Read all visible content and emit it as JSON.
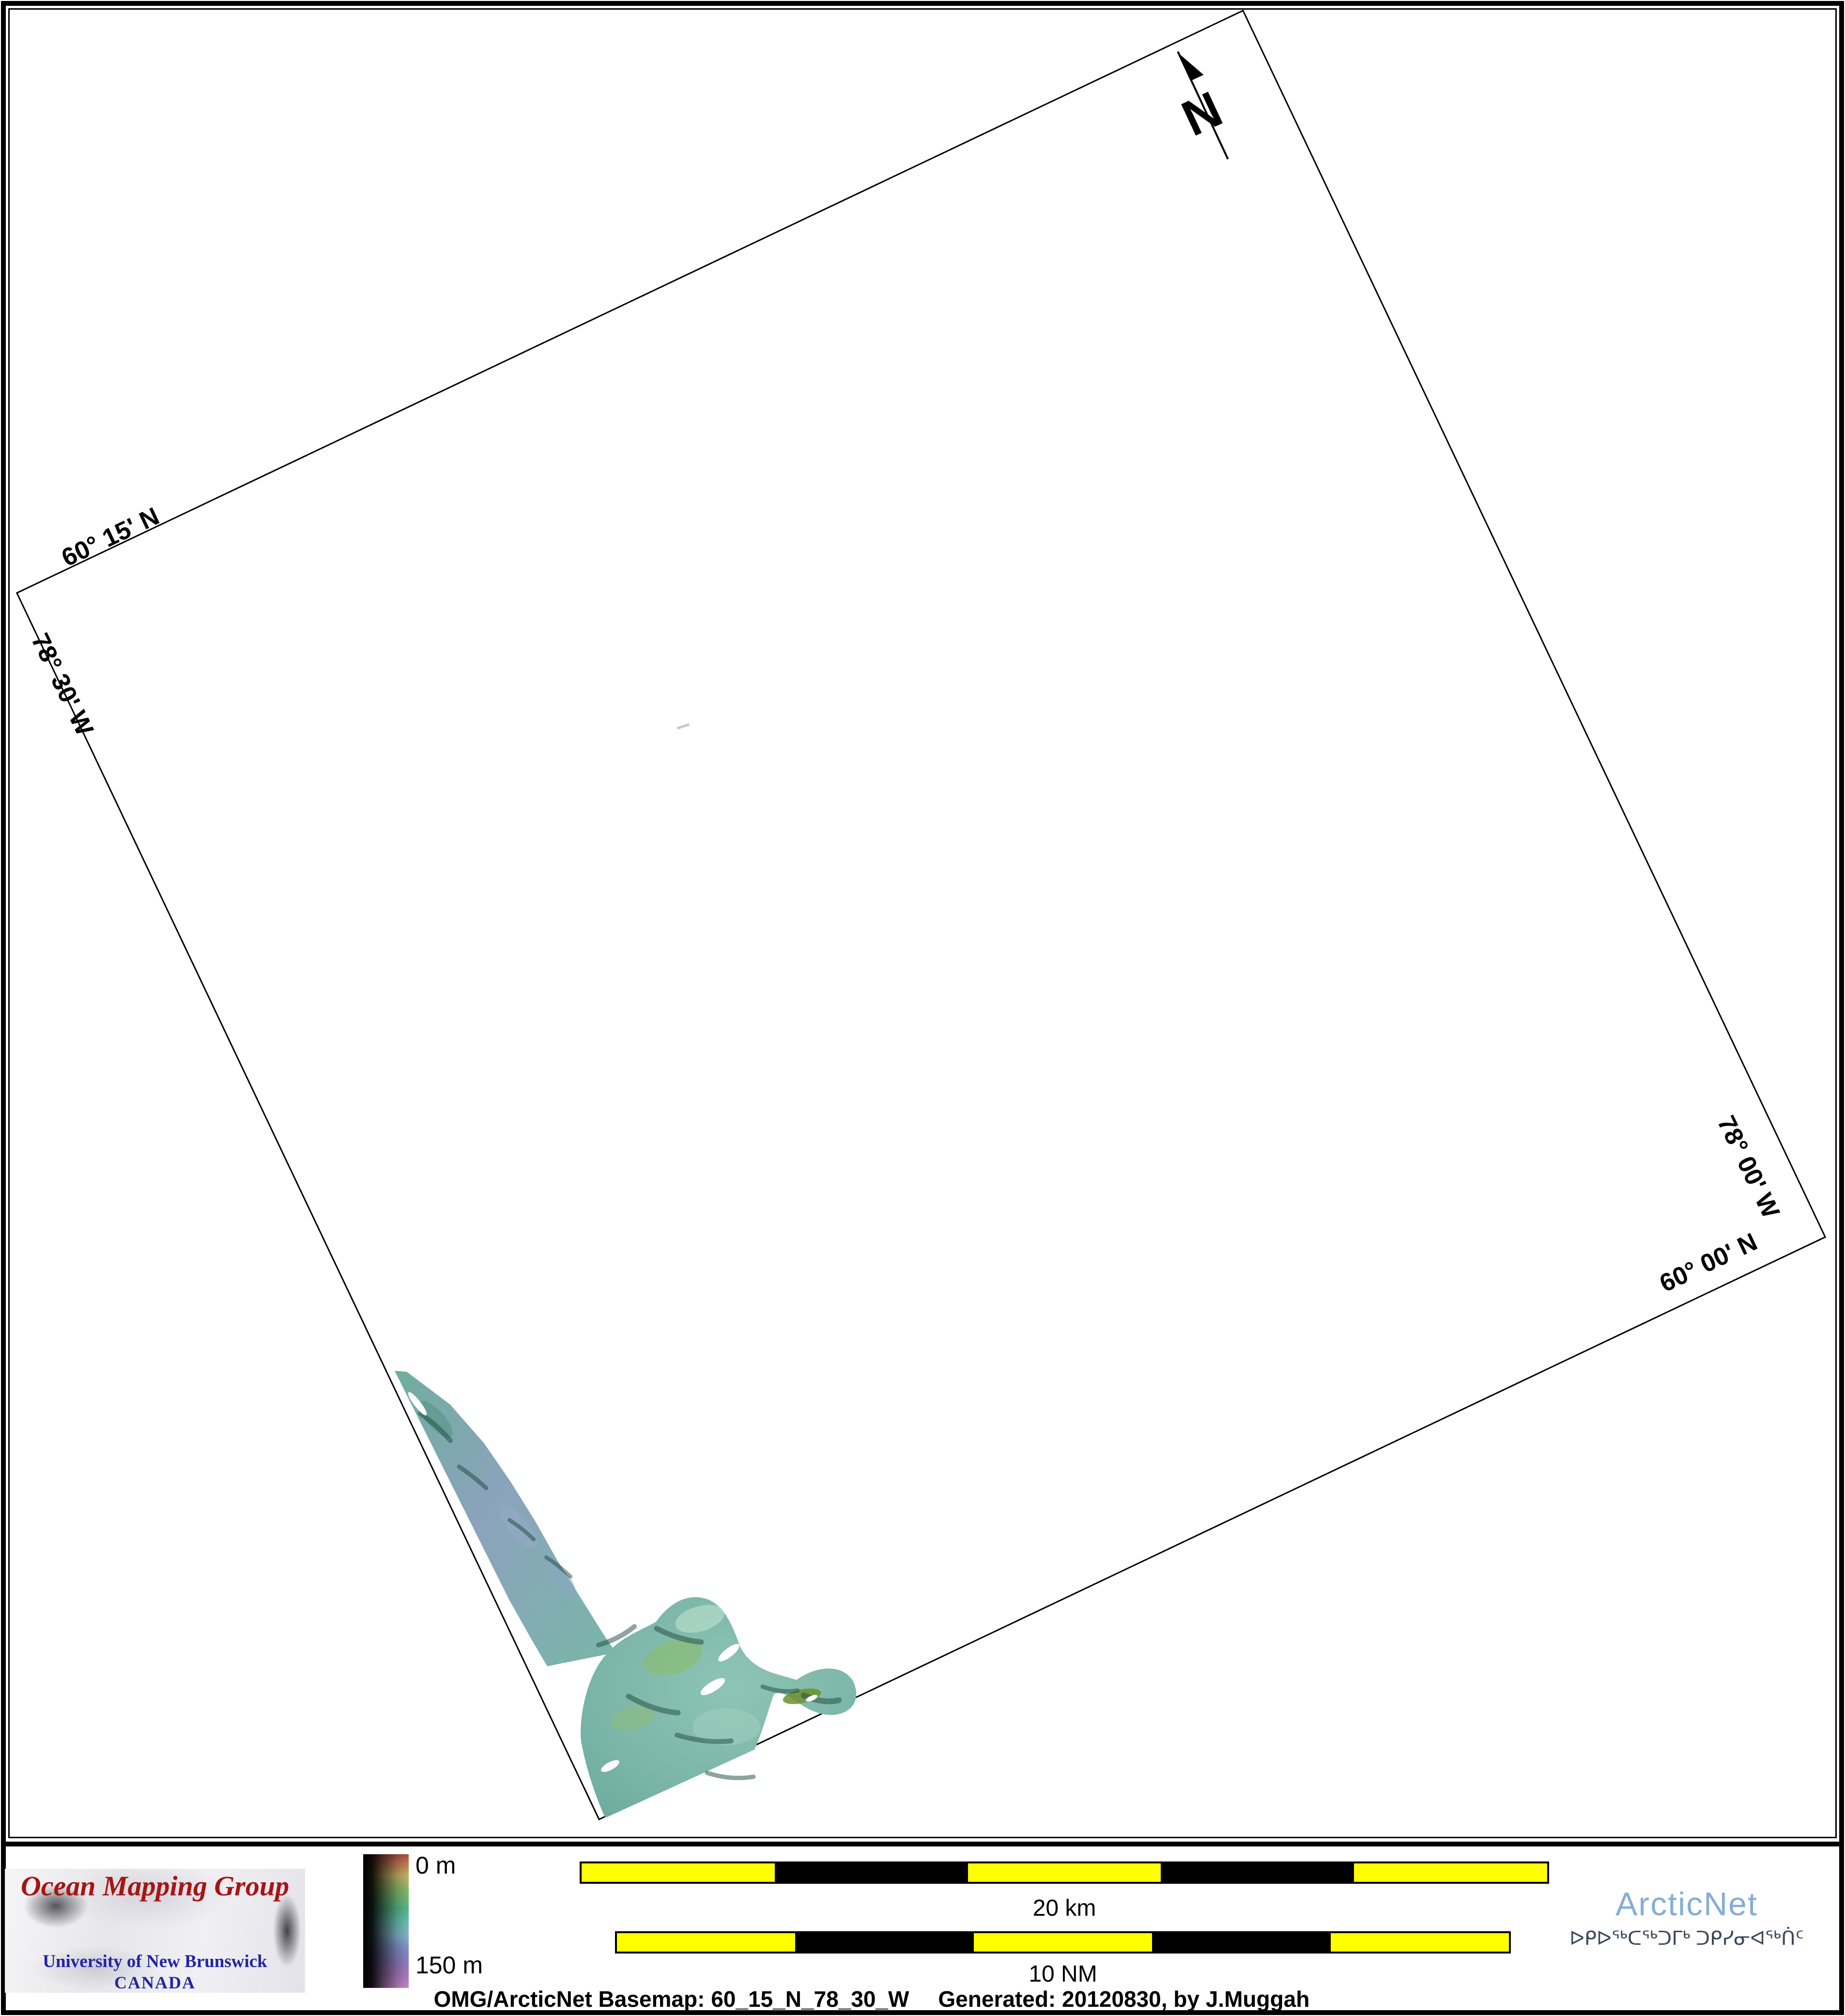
{
  "map": {
    "graticule_labels": [
      {
        "position": "top-left",
        "text": "60° 15' N"
      },
      {
        "position": "left",
        "text": "78° 30' W"
      },
      {
        "position": "right",
        "text": "78° 00' W"
      },
      {
        "position": "bottom-right",
        "text": "60° 00' N"
      }
    ],
    "north_arrow_label": "N"
  },
  "depth_legend": {
    "top_label": "0 m",
    "bottom_label": "150 m",
    "min_depth_m": 0,
    "max_depth_m": 150
  },
  "scale_bars": [
    {
      "id": "km",
      "label": "20 km",
      "length": 20,
      "unit": "km",
      "segments": 5
    },
    {
      "id": "nm",
      "label": "10 NM",
      "length": 10,
      "unit": "NM",
      "segments": 5
    }
  ],
  "logos": {
    "omg": {
      "title": "Ocean Mapping Group",
      "university": "University of New Brunswick",
      "country": "CANADA"
    },
    "arcticnet": {
      "name": "ArcticNet",
      "tagline_syllabics": "ᐅᑭᐅᖅᑕᖅᑐᒥᒃ ᑐᑭᓯᓂᐊᖅᑏᑦ"
    }
  },
  "caption": {
    "basemap": "OMG/ArcticNet Basemap: 60_15_N_78_30_W",
    "generated": "Generated: 20120830, by J.Muggah"
  },
  "colors": {
    "scalebar_yellow": "#ffff00",
    "scalebar_black": "#000000",
    "omg_red": "#a81414",
    "unb_blue": "#2424a4",
    "arcticnet_blue": "#86add8",
    "syllabics_slate": "#3a4757",
    "swath_teal": "#79b6a8"
  }
}
